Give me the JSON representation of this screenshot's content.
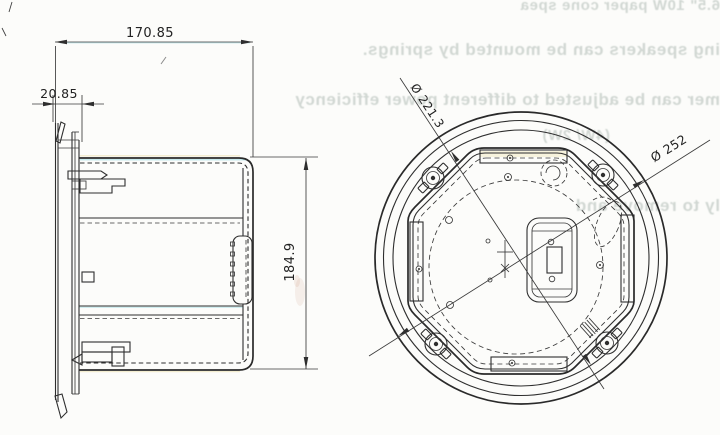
{
  "colors": {
    "ink": "#2e2e2e",
    "paper": "#fcfcfa",
    "bleed_text": "#b7c1bb"
  },
  "side_view": {
    "dim_width": "170.85",
    "dim_flange": "20.85",
    "dim_height": "184.9"
  },
  "rear_view": {
    "dim_inner_diameter": "Ø 221.3",
    "dim_outer_diameter": "Ø 252"
  },
  "bleed_through": {
    "line1": "6.5\" 10W paper cone spea",
    "line2": "ing speakers can be mounted by springs.",
    "line3": "mer can be adjusted to different power efficiency",
    "line4": "(4W/ 2W)",
    "line5": "ly to remove and repla"
  }
}
